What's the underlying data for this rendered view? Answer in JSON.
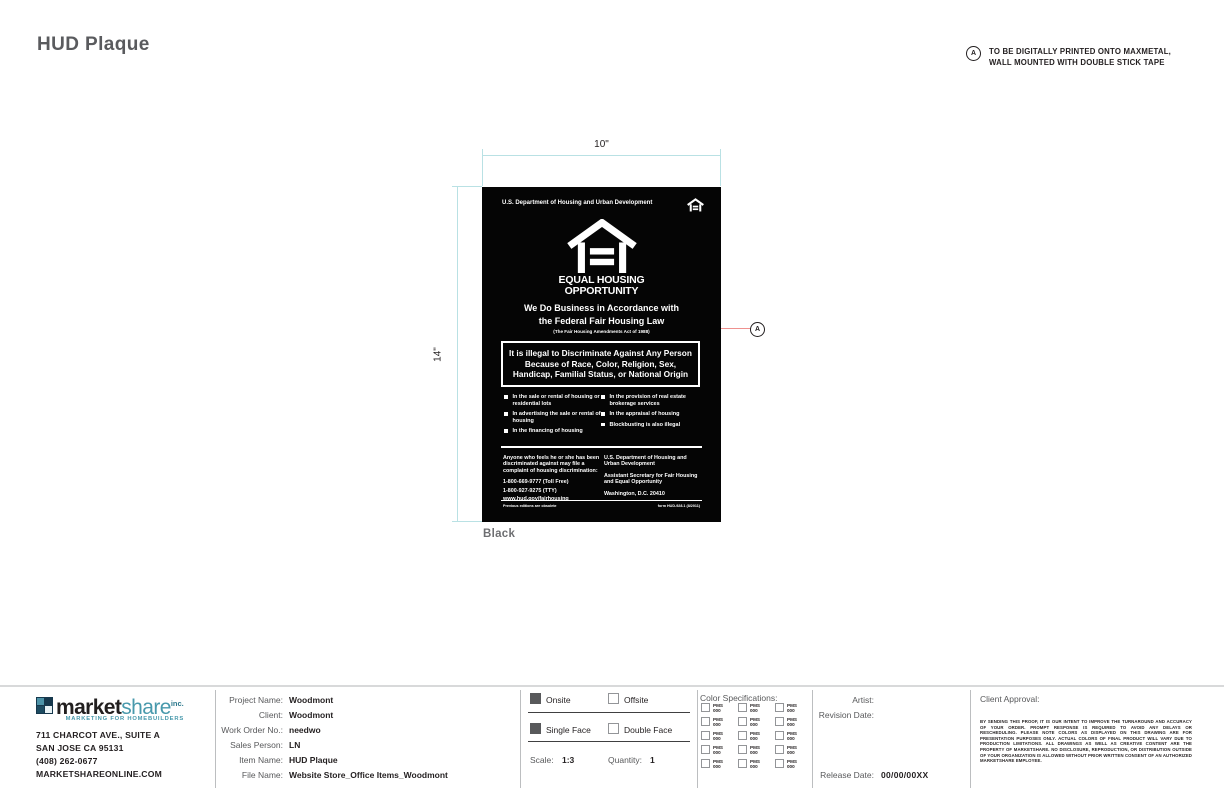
{
  "page": {
    "title": "HUD Plaque"
  },
  "note_a": {
    "marker": "A",
    "line1": "TO BE DIGITALLY PRINTED ONTO MAXMETAL,",
    "line2": "WALL MOUNTED WITH DOUBLE STICK TAPE"
  },
  "dimensions": {
    "width_label": "10\"",
    "height_label": "14\""
  },
  "callout": {
    "marker": "A"
  },
  "color_label": "Black",
  "plaque": {
    "dept_line": "U.S. Department of Housing and Urban Development",
    "logo_icon": "equal-housing-opportunity-logo",
    "logo_title_line1": "EQUAL HOUSING",
    "logo_title_line2": "OPPORTUNITY",
    "headline_line1": "We Do Business in Accordance with",
    "headline_line2": "the Federal Fair Housing Law",
    "subhead": "(The Fair Housing Amendments Act of 1988)",
    "box_text": "It is illegal to Discriminate Against Any Person Because of Race, Color, Religion, Sex, Handicap, Familial Status, or National Origin",
    "bullets_left": [
      "In the sale or rental of housing or residential lots",
      "In advertising the sale or rental of housing",
      "In the financing of housing"
    ],
    "bullets_right": [
      "In the provision of real estate brokerage services",
      "In the appraisal of housing",
      "Blockbusting is also illegal"
    ],
    "complaint_text": "Anyone who feels he or she has been discriminated against may file a complaint of housing discrimination:",
    "phone1": "1-800-669-9777 (Toll Free)",
    "phone2": "1-800-927-9275 (TTY)",
    "website": "www.hud.gov/fairhousing",
    "dept_block_line1": "U.S. Department of Housing and Urban Development",
    "dept_block_line2": "Assistant Secretary for Fair Housing and Equal Opportunity",
    "dept_block_line3": "Washington, D.C. 20410",
    "footer_left": "Previous editions are obsolete",
    "footer_right": "form HUD-928.1 (8/2011)"
  },
  "titleblock": {
    "logo": {
      "word_part1": "market",
      "word_part2": "share",
      "word_suffix": "inc.",
      "tagline": "MARKETING FOR HOMEBUILDERS",
      "icon": "marketshare-logo-mark"
    },
    "address_lines": [
      "711 CHARCOT AVE., SUITE A",
      "SAN JOSE CA 95131",
      "(408) 262-0677",
      "MARKETSHAREONLINE.COM"
    ],
    "fields": [
      {
        "label": "Project Name:",
        "value": "Woodmont"
      },
      {
        "label": "Client:",
        "value": "Woodmont"
      },
      {
        "label": "Work Order No.:",
        "value": "needwo"
      },
      {
        "label": "Sales Person:",
        "value": "LN"
      },
      {
        "label": "Item Name:",
        "value": "HUD Plaque"
      },
      {
        "label": "File Name:",
        "value": "Website Store_Office Items_Woodmont"
      }
    ],
    "options": {
      "onsite_label": "Onsite",
      "offsite_label": "Offsite",
      "single_face_label": "Single Face",
      "double_face_label": "Double Face",
      "onsite_checked": true,
      "offsite_checked": false,
      "single_face_checked": true,
      "double_face_checked": false,
      "scale_label": "Scale:",
      "scale_value": "1:3",
      "quantity_label": "Quantity:",
      "quantity_value": "1"
    },
    "color_specs": {
      "title": "Color Specifications:",
      "pms_line1": "PMS",
      "pms_line2": "000"
    },
    "artist_label": "Artist:",
    "revision_label": "Revision Date:",
    "release_label": "Release Date:",
    "release_value": "00/00/00XX",
    "client_approval": {
      "title": "Client Approval:",
      "fine_print": "BY SENDING THIS PROOF, IT IS OUR INTENT TO IMPROVE THE TURNAROUND AND ACCURACY OF YOUR ORDER. PROMPT RESPONSE IS REQUIRED TO AVOID ANY DELAYS OR RESCHEDULING. PLEASE NOTE COLORS AS DISPLAYED ON THIS DRAWING ARE FOR PRESENTATION PURPOSES ONLY. ACTUAL COLORS OF FINAL PRODUCT WILL VARY DUE TO PRODUCTION LIMITATIONS. ALL DRAWINGS AS WELL AS CREATIVE CONTENT ARE THE PROPERTY OF MARKETSHARE. NO DISCLOSURE, REPRODUCTION, OR DISTRIBUTION OUTSIDE OF YOUR ORGANIZATION IS ALLOWED WITHOUT PRIOR WRITTEN CONSENT OF AN AUTHORIZED MARKETSHARE EMPLOYEE."
    }
  },
  "colors": {
    "plaque_bg": "#000000",
    "dimension_line": "#b9e1e4",
    "callout_leader": "#ef918f",
    "brand_teal": "#4899ac",
    "label_gray": "#58595b",
    "checkbox_fill": "#58595b"
  }
}
